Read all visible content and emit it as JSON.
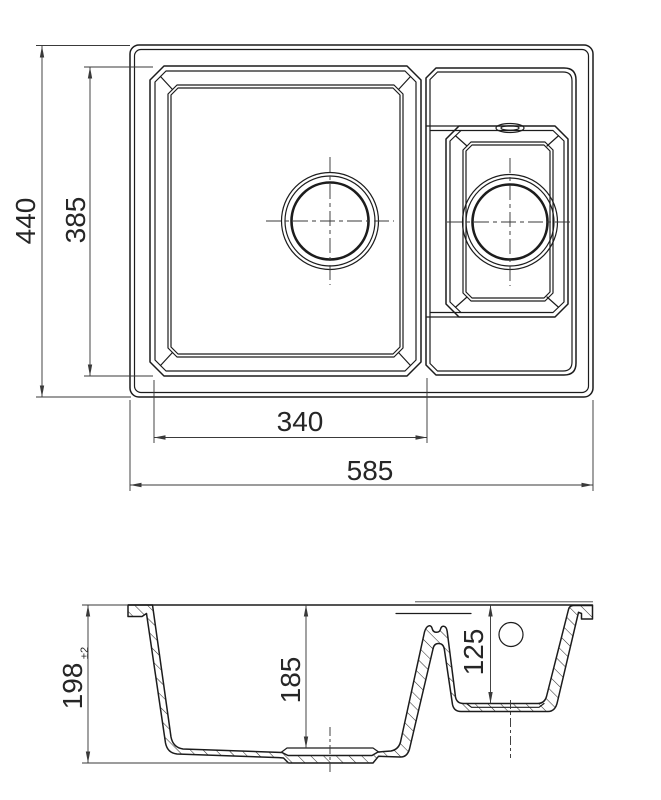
{
  "drawing": {
    "kind": "technical dimension drawing — kitchen sink with main bowl and half bowl",
    "top_view": {
      "overall_width_mm": "585",
      "overall_depth_mm": "440",
      "bowls_depth_mm": "385",
      "main_bowl_width_mm": "340"
    },
    "section_view": {
      "overall_height_mm": "198",
      "overall_height_tolerance": "±2",
      "main_bowl_depth_mm": "185",
      "small_bowl_depth_mm": "125"
    }
  },
  "colors": {
    "line": "#1c1c1c",
    "dim": "#3a3a3a",
    "text": "#262626",
    "bg": "#ffffff"
  }
}
